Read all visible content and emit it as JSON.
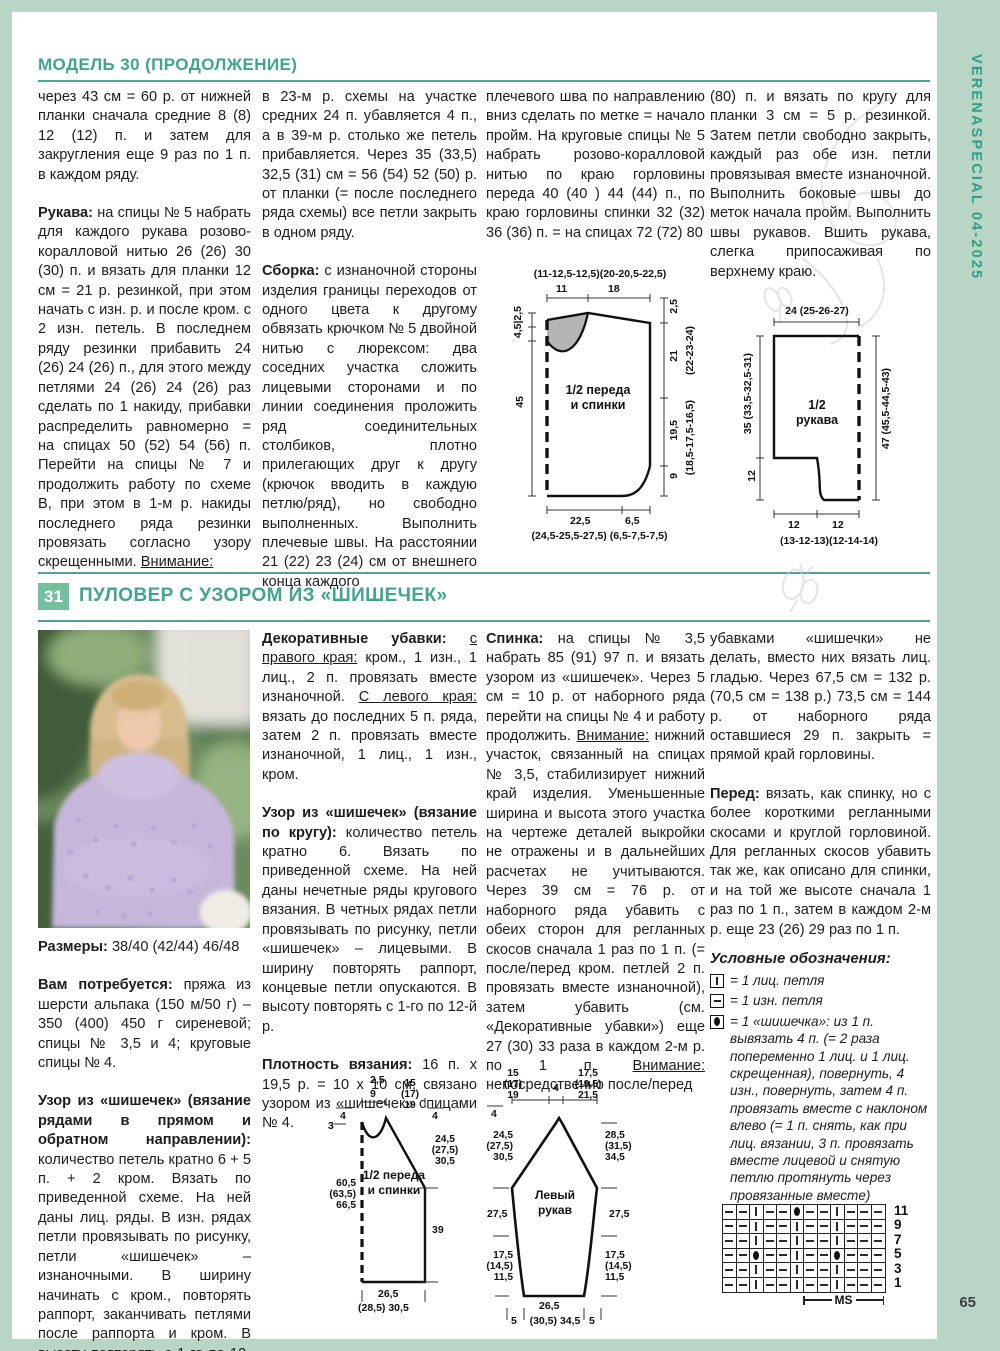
{
  "page": {
    "spine_text": "VERENASPECIAL 04-2025",
    "page_number": "65"
  },
  "model30": {
    "header": "МОДЕЛЬ 30 (ПРОДОЛЖЕНИЕ)",
    "col1": [
      [
        {
          "t": "через 43 см = 60 р. от нижней планки сначала средние 8 (8) 12 (12) п. и затем для закругления еще 9 раз по 1 п. в каждом ряду."
        }
      ],
      [
        {
          "s": "b",
          "t": "Рукава: "
        },
        {
          "t": "на спицы № 5 набрать для каждого рукава розово-коралловой нитью 26 (26) 30 (30) п. и вязать для планки 12 см = 21 р. резинкой, при этом начать с изн. р. и после кром. с 2 изн. петель. В последнем ряду резинки прибавить 24 (26) 24 (26) п., для этого между петлями 24 (26) 24 (26) раз сделать по 1 накиду, прибавки распределить равномерно = на спицах 50 (52) 54 (56) п. Перейти на спицы № 7 и продолжить работу по схеме В, при этом в 1-м р. накиды последнего ряда резинки провязать согласно узору скрещенными. "
        },
        {
          "s": "u",
          "t": "Внимание:"
        }
      ]
    ],
    "col2": [
      [
        {
          "t": "в 23-м р. схемы на участке средних 24 п. убавляется 4 п., а в 39-м р. столько же петель прибавляется. Через 35 (33,5) 32,5 (31) см = 56 (54) 52 (50) р. от планки (= после последнего ряда схемы) все петли закрыть в одном ряду."
        }
      ],
      [
        {
          "s": "b",
          "t": "Сборка: "
        },
        {
          "t": "с изнаночной стороны изделия границы переходов от одного цвета к другому обвязать крючком № 5 двойной нитью с люрексом: два соседних участка сложить лицевыми сторонами и по линии соединения проложить ряд соединительных столбиков, плотно прилегающих друг к другу (крючок вводить в каждую петлю/ряд), но свободно выполненных. Выполнить плечевые швы. На расстоянии 21 (22) 23 (24) см от внешнего конца каждого"
        }
      ]
    ],
    "col3": [
      [
        {
          "t": "плечевого шва по направлению вниз сделать по метке = начало пройм. На круговые спицы № 5 набрать розово-коралловой нитью по краю горловины переда 40 (40 ) 44 (44) п., по краю горловины спинки 32 (32) 36 (36) п. = на спицах 72 (72) 80"
        }
      ]
    ],
    "col4": [
      [
        {
          "t": "(80) п. и вязать по кругу для планки 3 см = 5 р. резинкой. Затем петли свободно закрыть, каждый раз обе изн. петли провязывая вместе изнаночной. Выполнить боковые швы до меток начала пройм. Выполнить швы рукавов. Вшить рукава, слегка припосаживая по верхнему краю."
        }
      ]
    ],
    "diagram_body": {
      "title": "1/2 переда\nи спинки",
      "top_sizes": "(11-12,5-12,5)(20-20,5-22,5)",
      "top_11": "11",
      "top_18": "18",
      "left_neck": "4,5|2,5",
      "left_45": "45",
      "right_25": "2,5",
      "right_21": "21",
      "right_21_alt": "(22-23-24)",
      "right_195": "19,5",
      "right_195_alt": "(18,5-17,5-16,5)",
      "right_9": "9",
      "bottom_225": "22,5",
      "bottom_65": "6,5",
      "bottom_sizes": "(24,5-25,5-27,5) (6,5-7,5-7,5)"
    },
    "diagram_sleeve": {
      "title": "1/2\nрукава",
      "top": "24 (25-26-27)",
      "left_35": "35 (33,5-32,5-31)",
      "left_12": "12",
      "right_47": "47 (45,5-44,5-43)",
      "bottom_12a": "12",
      "bottom_12b": "12",
      "bottom_sizes": "(13-12-13)(12-14-14)"
    }
  },
  "model31": {
    "number": "31",
    "title": "ПУЛОВЕР С УЗОРОМ ИЗ «ШИШЕЧЕК»",
    "col1": [
      [
        {
          "s": "b",
          "t": "Размеры: "
        },
        {
          "t": "38/40 (42/44) 46/48"
        }
      ],
      [
        {
          "s": "b",
          "t": "Вам потребуется: "
        },
        {
          "t": "пряжа из шерсти альпака (150 м/50 г) – 350 (400) 450 г сиреневой; спицы № 3,5 и 4; круговые спицы № 4."
        }
      ],
      [
        {
          "s": "b",
          "t": "Узор из «шишечек» (вязание рядами в прямом и обратном направлении): "
        },
        {
          "t": "количество петель кратно 6 + 5 п. + 2 кром. Вязать по приведенной схеме. На ней даны лиц. ряды. В изн. рядах петли провязывать по рисунку, петли «шишечек» – изнаночными. В ширину начинать с кром., повторять раппорт, заканчивать петлями после раппорта и кром. В высоту повторять с 1-го по 12-й р."
        }
      ]
    ],
    "col2": [
      [
        {
          "s": "b",
          "t": "Декоративные убавки: "
        },
        {
          "s": "u",
          "t": "с правого края:"
        },
        {
          "t": " кром., 1 изн., 1 лиц., 2 п. провязать вместе изнаночной. "
        },
        {
          "s": "u",
          "t": "С левого края:"
        },
        {
          "t": " вязать до последних 5 п. ряда, затем 2 п. провязать вместе изнаночной, 1 лиц., 1 изн., кром."
        }
      ],
      [
        {
          "s": "b",
          "t": "Узор из «шишечек» (вязание по кругу): "
        },
        {
          "t": "количество петель кратно 6. Вязать по приведенной схеме. На ней даны нечетные ряды кругового вязания. В четных рядах петли провязывать по рисунку, петли «шишечек» – лицевыми. В ширину повторять раппорт, концевые петли опускаются. В высоту повторять с 1-го по 12-й р."
        }
      ],
      [
        {
          "s": "b",
          "t": "Плотность вязания: "
        },
        {
          "t": "16 п. x 19,5 р. = 10 x 10 см, связано узором из «шишечек» спицами № 4."
        }
      ]
    ],
    "col3": [
      [
        {
          "s": "b",
          "t": "Спинка: "
        },
        {
          "t": "на спицы № 3,5 набрать 85 (91) 97 п. и вязать узором из «шишечек». Через 5 см = 10 р. от наборного ряда перейти на спицы № 4 и работу продолжить. "
        },
        {
          "s": "u",
          "t": "Внимание:"
        },
        {
          "t": " нижний участок, связанный на спицах № 3,5, стабилизирует нижний край изделия. Уменьшенные ширина и высота этого участка на чертеже деталей выкройки не отражены и в дальнейших расчетах не учитываются. Через 39 см = 76 р. от наборного ряда убавить с обеих сторон для регланных скосов сначала 1 раз по 1 п. (= после/перед кром. петлей 2 п. провязать вместе изнаночной), затем убавить (см. «Декоративные убавки») еще 27 (30) 33 раза в каждом 2-м р. по 1 п. "
        },
        {
          "s": "u",
          "t": "Внимание:"
        },
        {
          "t": " непосредственно после/перед"
        }
      ]
    ],
    "col4": [
      [
        {
          "t": "убавками «шишечки» не делать, вместо них вязать лиц. гладью. Через 67,5 см = 132 р. (70,5 см = 138 р.) 73,5 см = 144 р. от наборного ряда оставшиеся 29 п. закрыть = прямой край горловины."
        }
      ],
      [
        {
          "s": "b",
          "t": "Перед: "
        },
        {
          "t": "вязать, как спинку, но с более короткими регланными скосами и круглой горловиной. Для регланных скосов убавить так же, как описано для спинки, и на той же высоте сначала 1 раз по 1 п., затем в каждом 2-м р. еще 23 (26) 29 раз по 1 п."
        }
      ]
    ],
    "legend": {
      "title": "Условные обозначения:",
      "knit": "= 1 лиц. петля",
      "purl": "= 1 изн. петля",
      "bobble": "= 1 «шишечка»: из 1 п. вывязать 4 п. (= 2 раза попеременно 1 лиц. и 1 лиц. скрещенная), повернуть, 4 изн., повернуть, затем 4 п. провязать вместе с наклоном влево (= 1 п. снять, как при лиц. вязании, 3 п. провязать вместе лицевой и снятую петлю протянуть через провязанные вместе)"
    },
    "diagram_front": {
      "title": "1/2 переда\nи спинки",
      "top_25": "2,5",
      "top_9": "9",
      "top_sizes": "15\n(17)\n19",
      "left_4": "4",
      "left_3": "3",
      "left_sizes": "60,5\n(63,5)\n66,5",
      "right_4": "4",
      "right_sizes": "24,5\n(27,5)\n30,5",
      "right_39": "39",
      "bottom_1": "26,5",
      "bottom_2": "(28,5) 30,5"
    },
    "diagram_left_sleeve": {
      "title": "Левый\nрукав",
      "top_left": "15\n(17)\n19",
      "top_4": "4",
      "top_right": "17,5\n(19,5)\n21,5",
      "left_4": "4",
      "left_top": "24,5\n(27,5)\n30,5",
      "left_mid": "27,5",
      "left_bot": "17,5\n(14,5)\n11,5",
      "right_top": "28,5\n(31,5)\n34,5",
      "right_mid": "27,5",
      "right_bot": "17,5\n(14,5)\n11,5",
      "bottom_5a": "5",
      "bottom_c": "26,5",
      "bottom_c2": "(30,5) 34,5",
      "bottom_5b": "5"
    },
    "chart": {
      "ms_label": "MS",
      "rows": [
        {
          "label": "11",
          "cells": [
            "-",
            "-",
            "|",
            "-",
            "-",
            "●",
            "-",
            "-",
            "|",
            "-",
            "-",
            "-"
          ]
        },
        {
          "label": "9",
          "cells": [
            "-",
            "-",
            "|",
            "-",
            "-",
            "|",
            "-",
            "-",
            "|",
            "-",
            "-",
            "-"
          ]
        },
        {
          "label": "7",
          "cells": [
            "-",
            "-",
            "|",
            "-",
            "-",
            "|",
            "-",
            "-",
            "|",
            "-",
            "-",
            "-"
          ]
        },
        {
          "label": "5",
          "cells": [
            "-",
            "-",
            "●",
            "-",
            "-",
            "|",
            "-",
            "-",
            "●",
            "-",
            "-",
            "-"
          ]
        },
        {
          "label": "3",
          "cells": [
            "-",
            "-",
            "|",
            "-",
            "-",
            "|",
            "-",
            "-",
            "|",
            "-",
            "-",
            "-"
          ]
        },
        {
          "label": "1",
          "cells": [
            "-",
            "-",
            "|",
            "-",
            "-",
            "|",
            "-",
            "-",
            "|",
            "-",
            "-",
            "-"
          ]
        }
      ]
    }
  }
}
